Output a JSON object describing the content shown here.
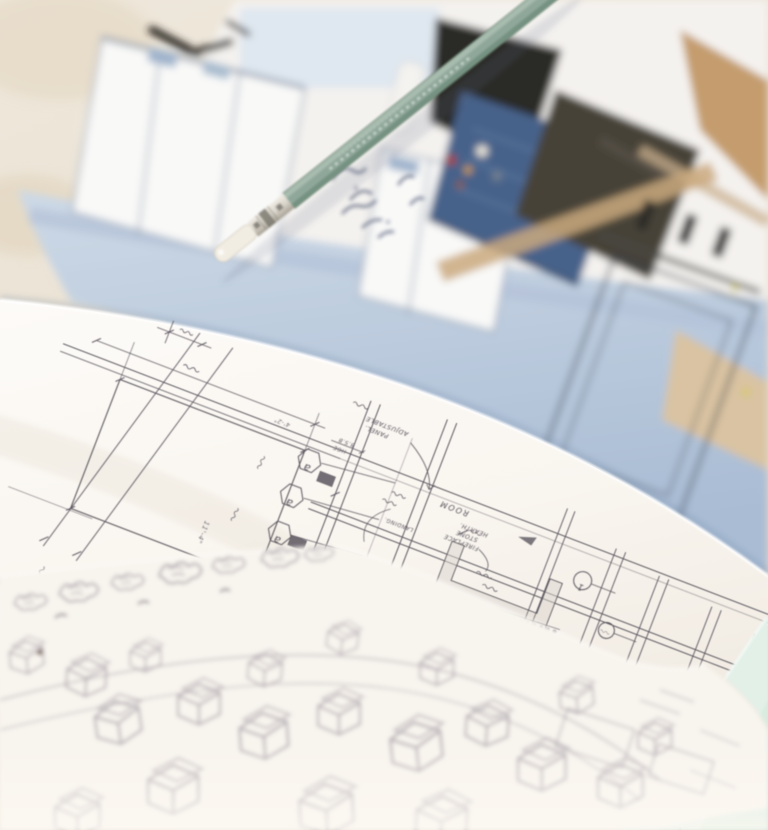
{
  "scene": {
    "title": "Architectural sketches, printed photograph and a green drawing pencil on a desk"
  },
  "colors": {
    "desk_beige": "#eee7db",
    "photo_paper": "#f4f2ef",
    "photo_blue_top": "#cdd9e6",
    "photo_blue_bottom": "#a9bcd4",
    "panel_white": "#f9f9f8",
    "panel_outline": "#93a0b4",
    "frame_dark": "#3a4350",
    "navy": "#46628a",
    "navy_texture": "#7b99bd",
    "charcoal": "#474339",
    "black_object": "#2c2925",
    "tan": "#c49c6d",
    "wood_light": "#d9c3a2",
    "pencil_green": "#8fa79a",
    "pencil_green_light": "#aabfb0",
    "pencil_green_dark": "#73907f",
    "eraser_cream": "#f2ede3",
    "ferrule_silver": "#d9d4ca",
    "ink": "#4e4853",
    "sheet_white": "#fcfaf6",
    "site_paper": "#f8f4ee",
    "site_line": "#8f8794",
    "mint": "#e2f0e8",
    "mint_deep": "#d7ebdf",
    "scribble_blue": "#3a4565"
  },
  "drawing": {
    "bubbles": [
      "a",
      "a",
      "a"
    ],
    "circled": [
      "1"
    ],
    "labels": {
      "room": "ROOM",
      "hearth": "HEARTH.",
      "stone": "STONE",
      "fireplace": "FIREPLACE",
      "adjustable": "ADJUSTABLE",
      "panel": "PANEL.",
      "bsb": "B.S.B",
      "hge": "HGE",
      "landing": "LANDING."
    },
    "dimensions": [
      "11'-4\"",
      "3'-2\"",
      "4'-2\"",
      "7'-6\"",
      "6'-8\""
    ]
  }
}
